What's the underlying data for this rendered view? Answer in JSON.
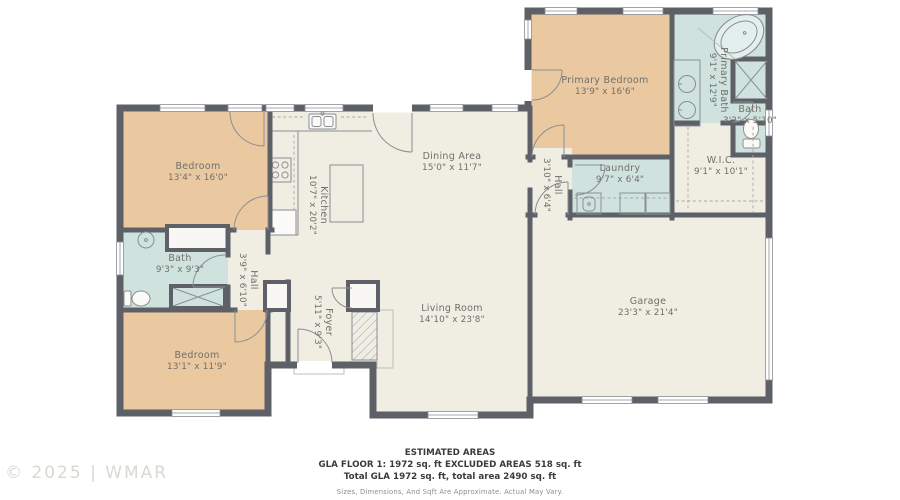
{
  "watermark": "© 2025 | WMAR",
  "colors": {
    "wall": "#5d6167",
    "bedroom_fill": "#eac9a0",
    "bath_fill": "#cfe2de",
    "living_fill": "#f0ede3",
    "label_text": "#6f6f6b",
    "fixture_line": "#8a8e94"
  },
  "rooms": {
    "primary_bedroom": {
      "name": "Primary Bedroom",
      "dims": "13'9\" x 16'6\""
    },
    "primary_bath": {
      "name": "Primary Bath",
      "dims": "9'1\" x 12'9\""
    },
    "bath_2": {
      "name": "Bath",
      "dims": "3'2\" x 5'10\""
    },
    "wic": {
      "name": "W.I.C.",
      "dims": "9'1\" x 10'1\""
    },
    "laundry": {
      "name": "Laundry",
      "dims": "9'7\" x 6'4\""
    },
    "hall_right": {
      "name": "Hall",
      "dims": "3'10\" x 6'4\""
    },
    "garage": {
      "name": "Garage",
      "dims": "23'3\" x 21'4\""
    },
    "dining": {
      "name": "Dining Area",
      "dims": "15'0\" x 11'7\""
    },
    "kitchen": {
      "name": "Kitchen",
      "dims": "10'7\" x 20'2\""
    },
    "living": {
      "name": "Living Room",
      "dims": "14'10\" x 23'8\""
    },
    "foyer": {
      "name": "Foyer",
      "dims": "5'11\" x 9'3\""
    },
    "bedroom_upper": {
      "name": "Bedroom",
      "dims": "13'4\" x 16'0\""
    },
    "bath_left": {
      "name": "Bath",
      "dims": "9'3\" x 9'3\""
    },
    "hall_left": {
      "name": "Hall",
      "dims": "3'9\" x 6'10\""
    },
    "bedroom_lower": {
      "name": "Bedroom",
      "dims": "13'1\" x 11'9\""
    }
  },
  "footer": {
    "title": "ESTIMATED AREAS",
    "line1": "GLA FLOOR 1: 1972 sq. ft EXCLUDED AREAS 518 sq. ft",
    "line2": "Total GLA 1972 sq. ft, total area 2490 sq. ft",
    "disclaimer": "Sizes, Dimensions, And Sqft Are Approximate. Actual May Vary."
  }
}
